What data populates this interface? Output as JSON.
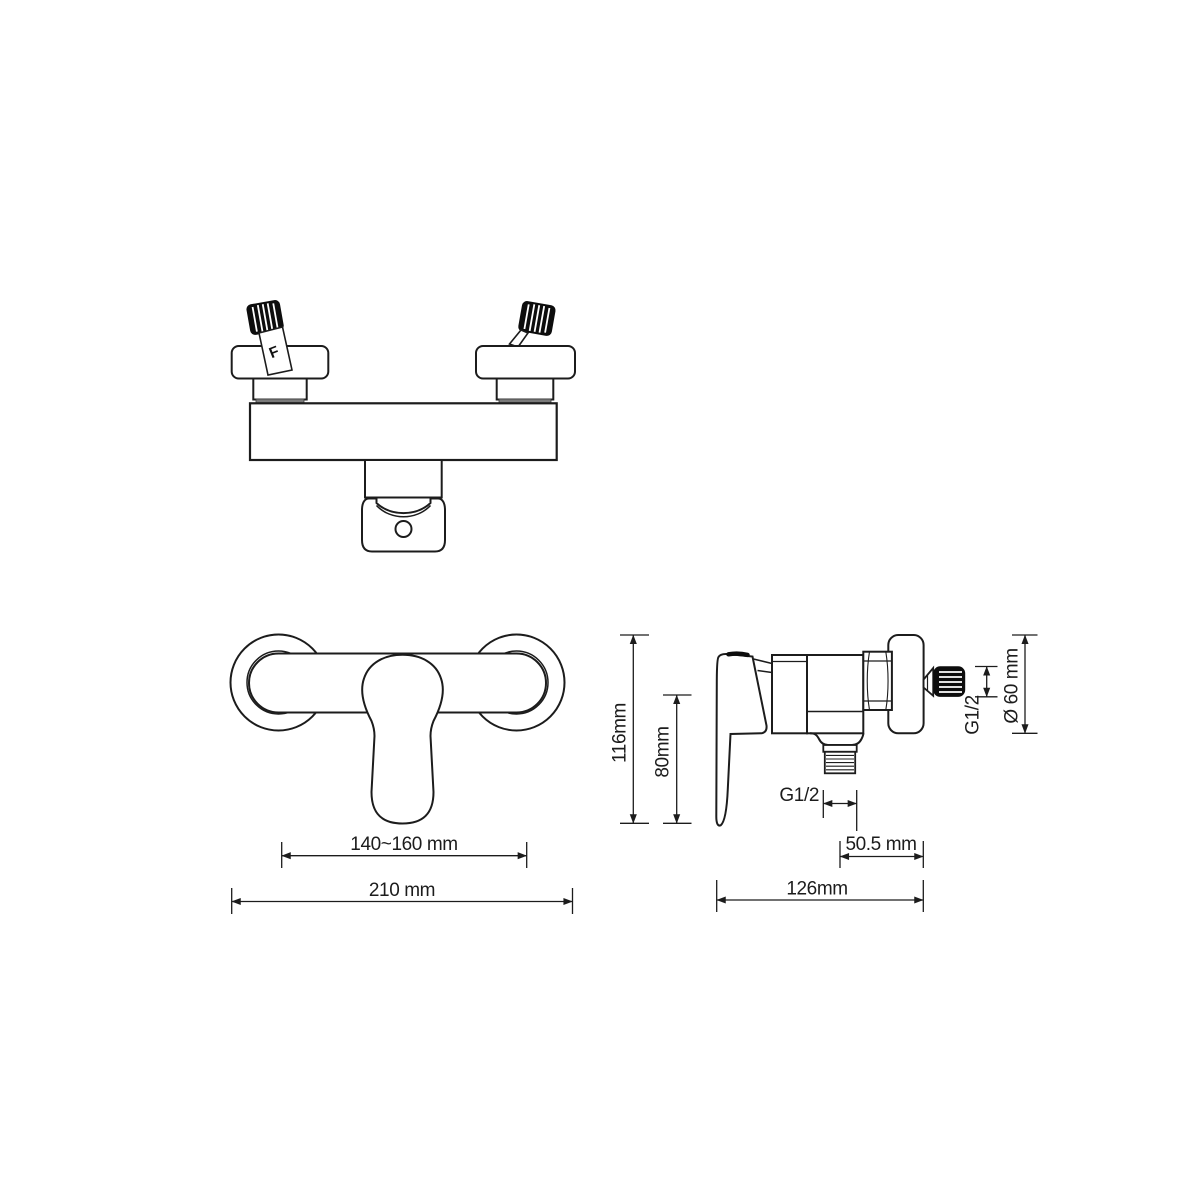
{
  "canvas": {
    "background": "#ffffff",
    "stroke_color": "#1c1c1c",
    "knob_color": "#0d0d0d",
    "gasket_color": "#7a7a7a",
    "description": "Technical dimension drawing of a wall-mounted single-lever shower mixer tap shown in three orthographic views"
  },
  "top_view": {
    "marking": "F"
  },
  "front_view": {
    "dim_handle_centers": "140~160 mm",
    "dim_overall_width": "210 mm"
  },
  "side_view": {
    "dim_overall_height": "116mm",
    "dim_lever_height": "80mm",
    "dim_outlet_thread": "G1/2",
    "dim_outlet_offset": "50.5  mm",
    "dim_overall_depth": "126mm",
    "dim_inlet_thread": "G1/2",
    "dim_flange_diameter": "Ø 60 mm"
  }
}
